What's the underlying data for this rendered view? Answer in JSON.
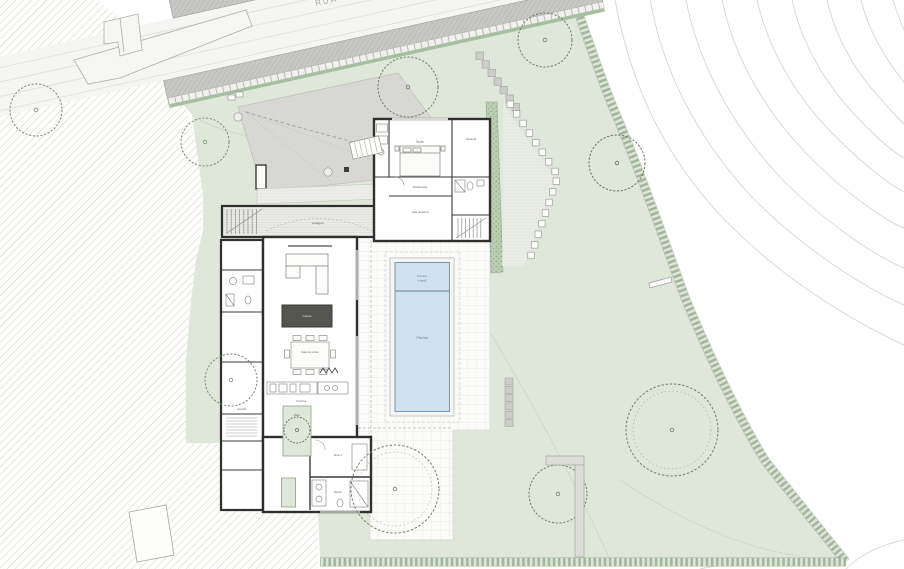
{
  "document": {
    "type": "architectural-site-plan"
  },
  "road": {
    "name": "RUA B"
  },
  "labels": {
    "suite": "Suíte",
    "varanda": "Varanda",
    "distribuicao": "Distribuição",
    "sala_privativa": "Sala privativa",
    "garagem": "Garagem",
    "escada": "Escada",
    "lareira": "Lareira",
    "sala_de_jantar": "Sala de jantar",
    "cozinha": "Cozinha",
    "patio": "Pátio",
    "suite_hospedes": "Suíte 2",
    "banho": "Banho",
    "piscina_infantil_1": "Piscina",
    "piscina_infantil_2": "infantil",
    "piscina": "Piscina"
  },
  "colors": {
    "garden_green": "#dfe7db",
    "pool_blue": "#cfe2ee",
    "pool_edge": "#7e9cb5",
    "road_gray": "#c7c7c3",
    "wall_dark": "#2f2f2d",
    "hatch_line": "#ccccc9",
    "boundary_green": "#8fa489"
  }
}
